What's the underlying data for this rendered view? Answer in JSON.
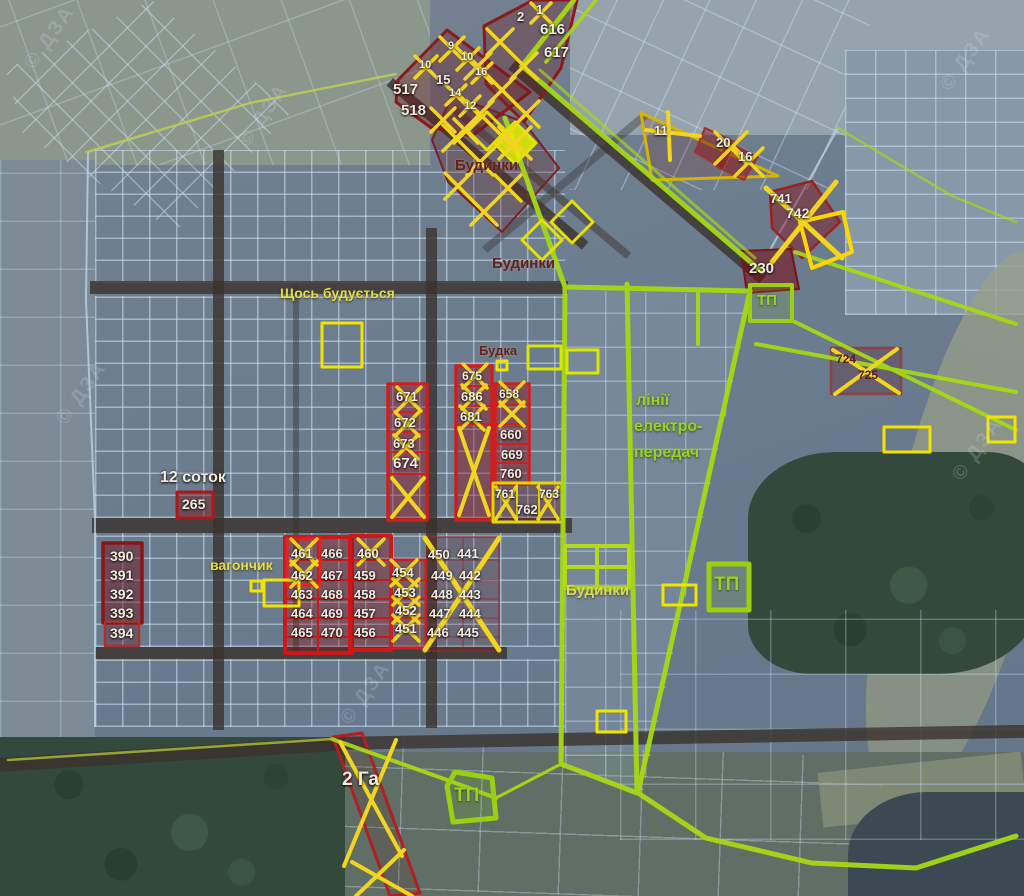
{
  "map_type": "satellite cadastral plot map",
  "watermark": "© ДЗА",
  "area_labels": {
    "budynky_top": "Будинки",
    "budynky_mid": "Будинки",
    "budynky_low": "Будинки",
    "construction": "Щось будується",
    "budka": "Будка",
    "vagonchyk": "вагончик",
    "power1": "лінії",
    "power2": "електро-",
    "power3": "передач",
    "size_12": "12 соток",
    "size_2ha": "2 Га",
    "tp_top": "ТП",
    "tp_mid": "ТП",
    "tp_bottom": "ТП"
  },
  "plot_numbers": {
    "n1": "1",
    "n2": "2",
    "n616": "616",
    "n617": "617",
    "n9": "9",
    "n10a": "10",
    "n10b": "10",
    "n15": "15",
    "n16a": "16",
    "n14": "14",
    "n12": "12",
    "n517": "517",
    "n518": "518",
    "n11": "11",
    "n20": "20",
    "n16b": "16",
    "n741": "741",
    "n742": "742",
    "n230": "230",
    "n724": "724",
    "n725": "725",
    "n671": "671",
    "n672": "672",
    "n673": "673",
    "n674": "674",
    "n675": "675",
    "n686": "686",
    "n681": "681",
    "n658": "658",
    "n660": "660",
    "n669": "669",
    "n760": "760",
    "n761": "761",
    "n762": "762",
    "n763": "763",
    "n265": "265",
    "n390": "390",
    "n391": "391",
    "n392": "392",
    "n393": "393",
    "n394": "394",
    "n461": "461",
    "n462": "462",
    "n463": "463",
    "n464": "464",
    "n465": "465",
    "n466": "466",
    "n467": "467",
    "n468": "468",
    "n469": "469",
    "n470": "470",
    "n460": "460",
    "n459": "459",
    "n458": "458",
    "n457": "457",
    "n456": "456",
    "n454": "454",
    "n453": "453",
    "n452": "452",
    "n451": "451",
    "n450": "450",
    "n449": "449",
    "n448": "448",
    "n447": "447",
    "n446": "446",
    "n441": "441",
    "n442": "442",
    "n443": "443",
    "n444": "444",
    "n445": "445"
  },
  "crossed_out_plots": [
    "1",
    "9",
    "10",
    "10",
    "16",
    "14",
    "12",
    "11",
    "20",
    "16",
    "741",
    "724",
    "725",
    "671",
    "672",
    "673",
    "675",
    "686",
    "681",
    "658",
    "659",
    "761",
    "763",
    "460",
    "461",
    "462",
    "451",
    "452",
    "453",
    "454",
    "441-450 area",
    "2 Га strip"
  ],
  "colors": {
    "highlight_red": "#cc1f1f",
    "dark_red_fill": "#6e1a1e",
    "cross_yellow": "#f2d51e",
    "power_line_green": "#a6d916",
    "parcel_blue": "#cfe2f6",
    "label_maroon": "#62211a"
  }
}
